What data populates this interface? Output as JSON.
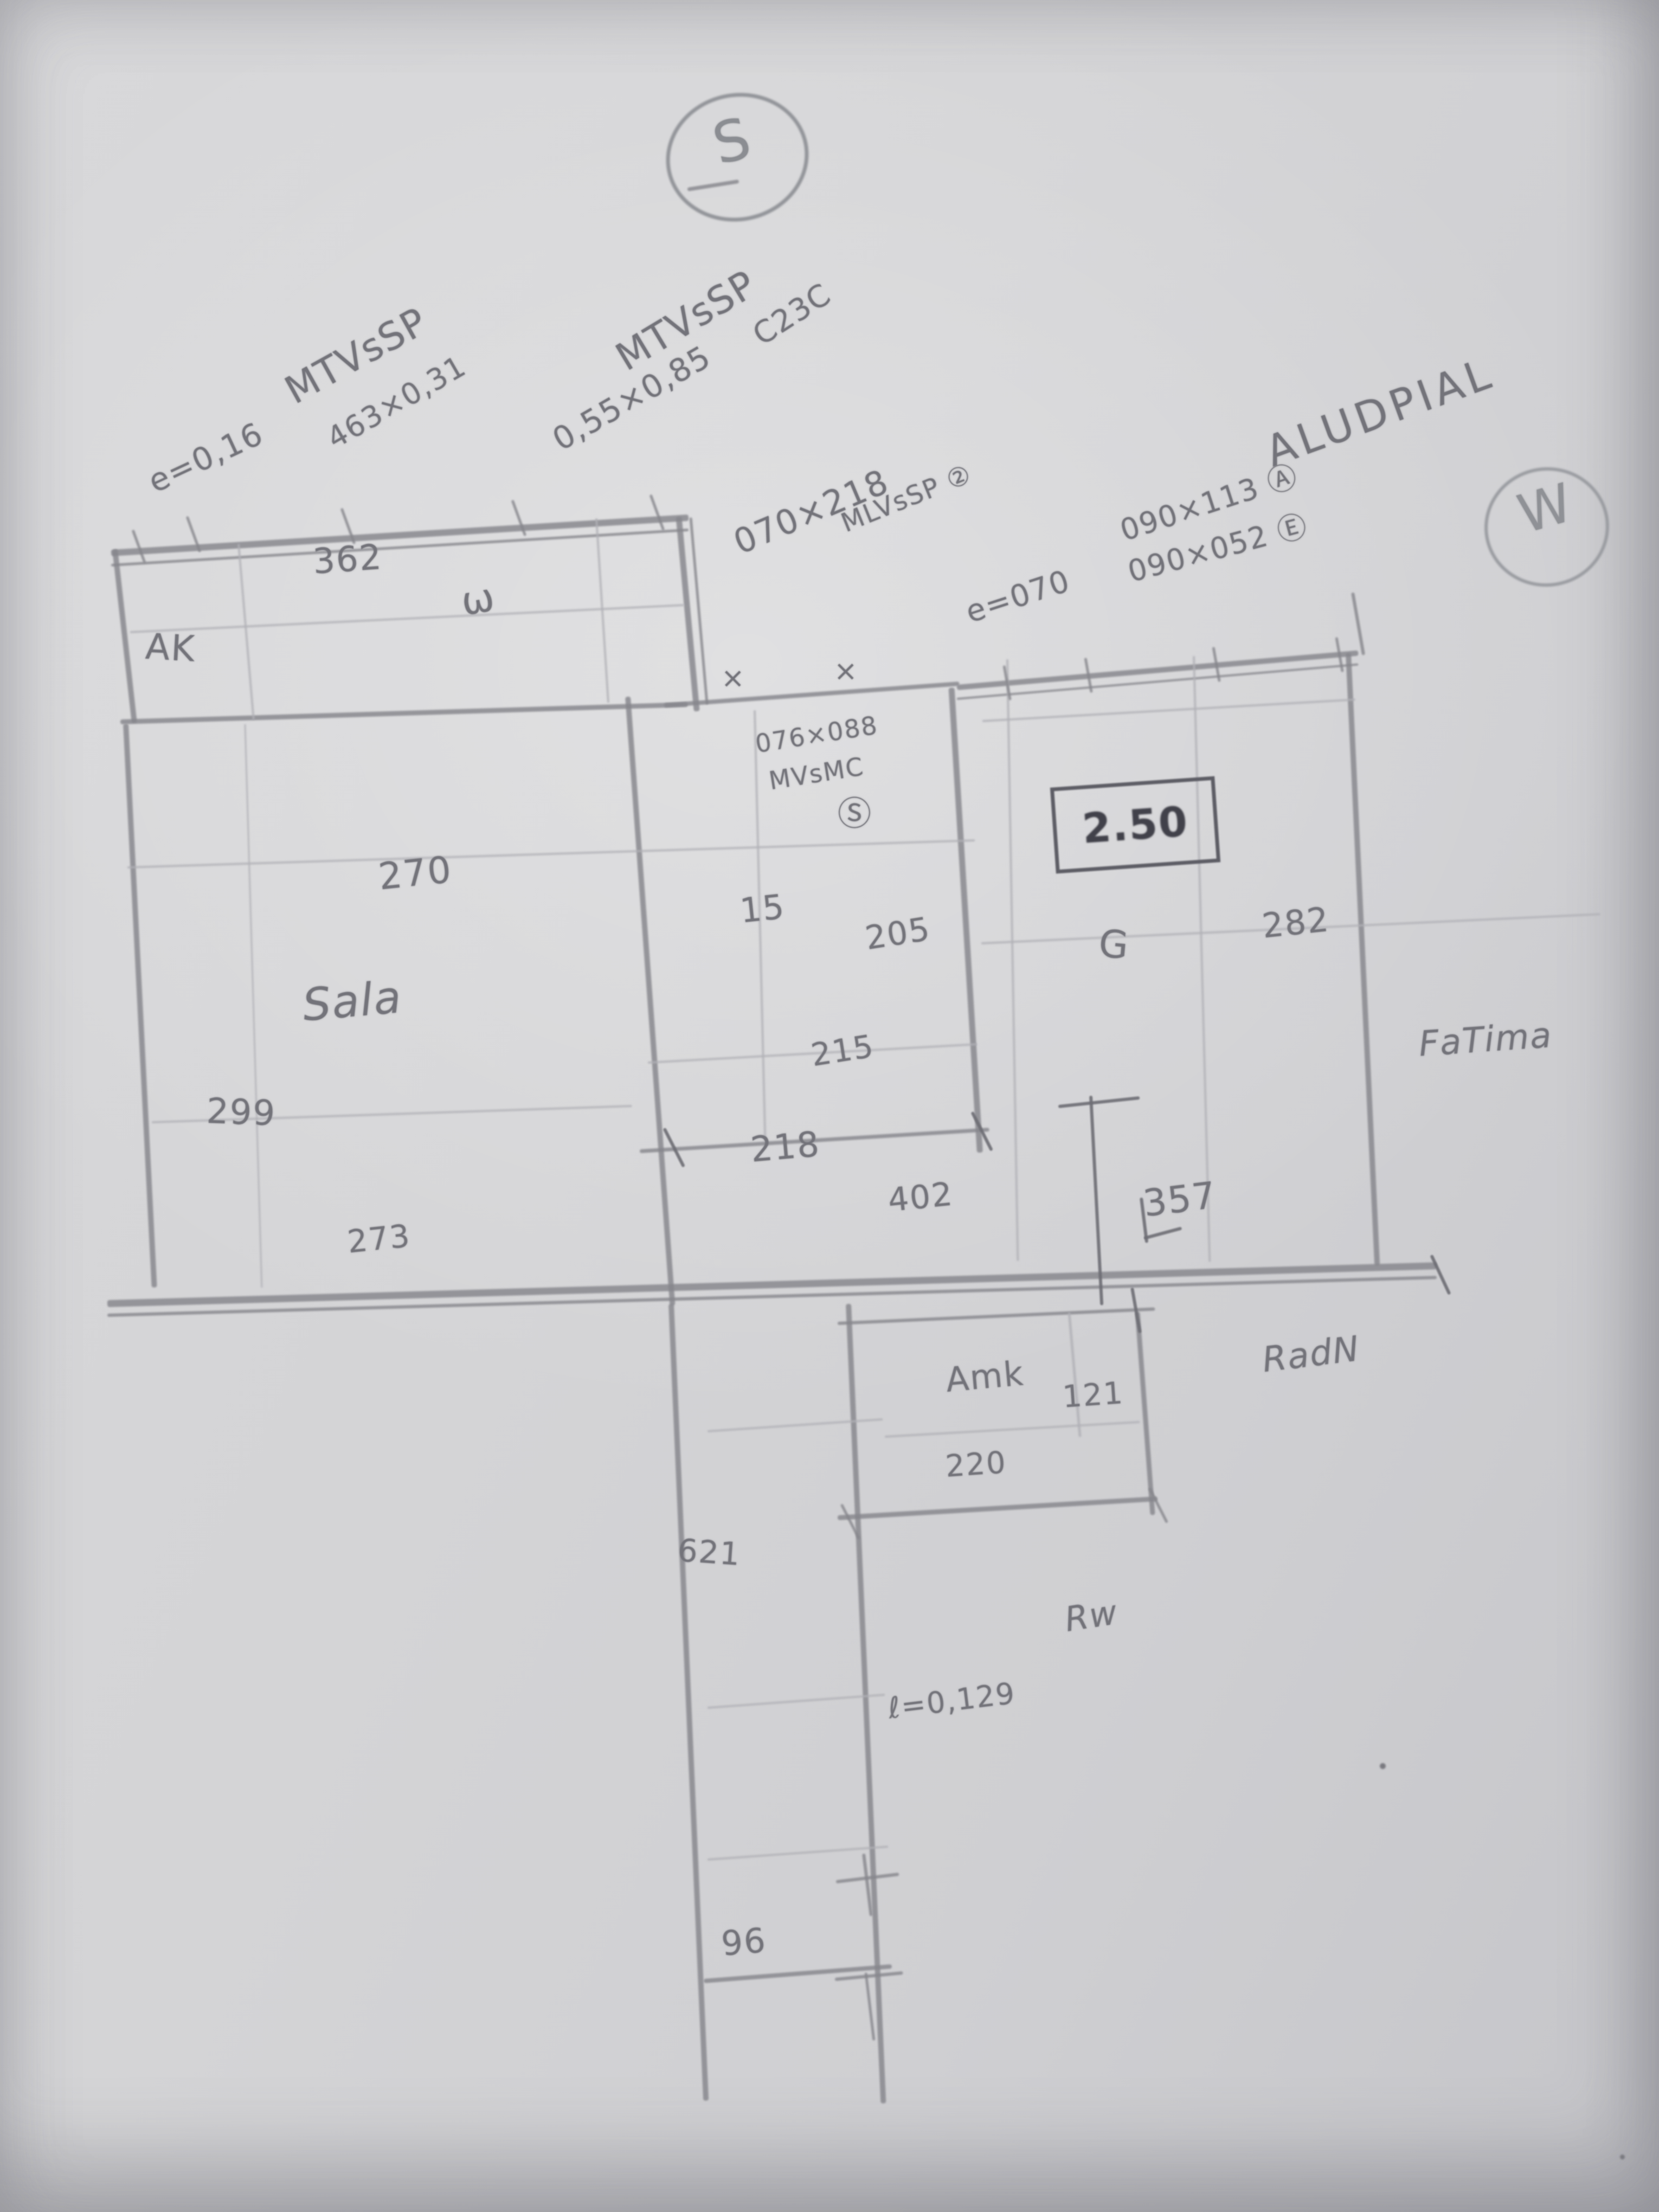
{
  "compass": {
    "south": "S",
    "west": "W"
  },
  "labels": {
    "mtv1": "MTVsSP",
    "e016": "e=0,16",
    "d463": "463×0,31",
    "mtv2": "MTVsSP",
    "d055": "0,55×0,85",
    "c23c": "C23C",
    "d070218": "070×218",
    "mlvssp2": "MLVsSP ②",
    "e070": "e=070",
    "aludpial": "ALUDPIAL",
    "d090113": "090×113 Ⓐ",
    "d090052": "090×052 Ⓔ",
    "n362": "362",
    "omega": "ω",
    "ak": "AK",
    "d076088": "076×088",
    "mvsmc": "MVsMC",
    "s2": "Ⓢ",
    "v250": "2.50",
    "n270": "270",
    "n15": "15",
    "n205": "205",
    "g": "G",
    "n282": "282",
    "sala": "Sala",
    "n215": "215",
    "fatima": "FaTima",
    "n299": "299",
    "n218": "218",
    "n402": "402",
    "n357": "357",
    "n273": "273",
    "amk": "Amk",
    "n121": "121",
    "radn": "RadN",
    "n220": "220",
    "n621": "621",
    "rw": "Rw",
    "l0129": "ℓ=0,129",
    "n96": "96",
    "x1": "×",
    "x2": "×"
  }
}
